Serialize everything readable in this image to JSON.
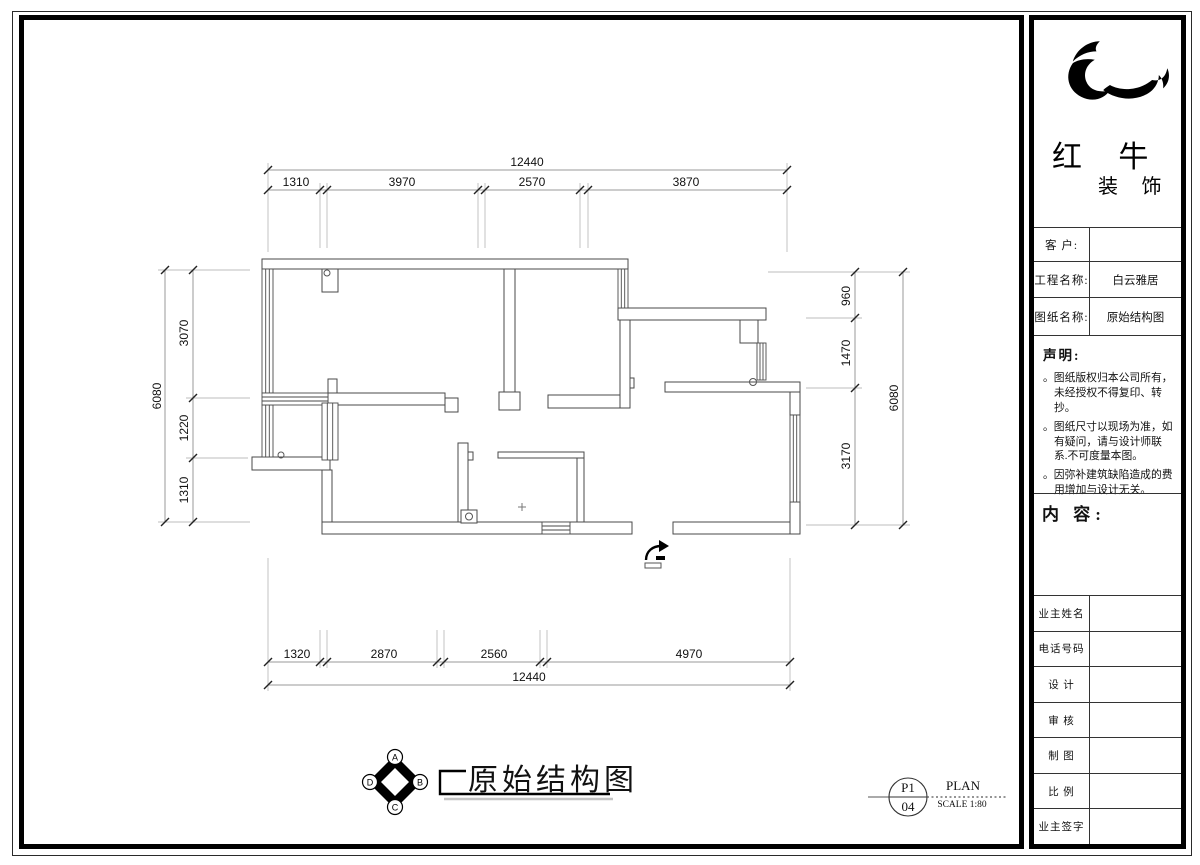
{
  "title_block": {
    "brand": {
      "name_chars": "红 牛",
      "suffix_chars": "装 饰"
    },
    "fields": [
      {
        "label": "客  户:",
        "value": ""
      },
      {
        "label": "工程名称:",
        "value": "白云雅居"
      },
      {
        "label": "图纸名称:",
        "value": "原始结构图"
      }
    ],
    "statement": {
      "heading": "声明:",
      "items": [
        "。图纸版权归本公司所有，未经授权不得复印、转抄。",
        "。图纸尺寸以现场为准，如有疑问，请与设计师联系.不可度量本图。",
        "。因弥补建筑缺陷造成的费用增加与设计无关。"
      ]
    },
    "content_heading": "内 容:",
    "sign_rows": [
      {
        "label": "业主姓名",
        "value": ""
      },
      {
        "label": "电话号码",
        "value": ""
      },
      {
        "label": "设  计",
        "value": ""
      },
      {
        "label": "审  核",
        "value": ""
      },
      {
        "label": "制  图",
        "value": ""
      },
      {
        "label": "比  例",
        "value": ""
      },
      {
        "label": "业主签字",
        "value": ""
      }
    ]
  },
  "drawing": {
    "plan_title": "原始结构图",
    "sheet": {
      "number_top": "P1",
      "number_bottom": "04",
      "type_label": "PLAN",
      "scale_label": "SCALE 1:80"
    },
    "compass": {
      "labels": [
        "A",
        "B",
        "C",
        "D"
      ]
    },
    "dimensions": {
      "top": {
        "total": "12440",
        "segments": [
          "1310",
          "3970",
          "2570",
          "3870"
        ]
      },
      "bottom": {
        "total": "12440",
        "segments": [
          "1320",
          "2870",
          "2560",
          "4970"
        ]
      },
      "left": {
        "total": "6080",
        "segments": [
          "3070",
          "1220",
          "1310"
        ]
      },
      "right": {
        "total": "6080",
        "segments": [
          "960",
          "1470",
          "3170"
        ]
      }
    }
  }
}
